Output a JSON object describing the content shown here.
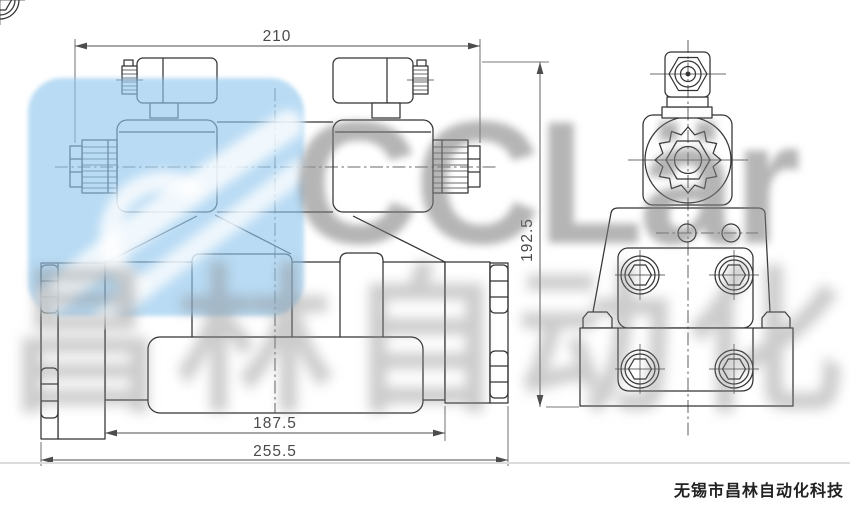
{
  "dimensions": {
    "overall_width_top": "210",
    "overall_height": "192.5",
    "mounting_width": "187.5",
    "overall_width_bottom": "255.5"
  },
  "watermark": {
    "brand": "CCLär",
    "brand_cn": "昌林自动化",
    "logo_blue": "#8fc6ee"
  },
  "footer": {
    "company": "无锡市昌林自动化科技"
  },
  "colors": {
    "drawing_line": "#333333",
    "dimension_text": "#4a4a4a"
  }
}
